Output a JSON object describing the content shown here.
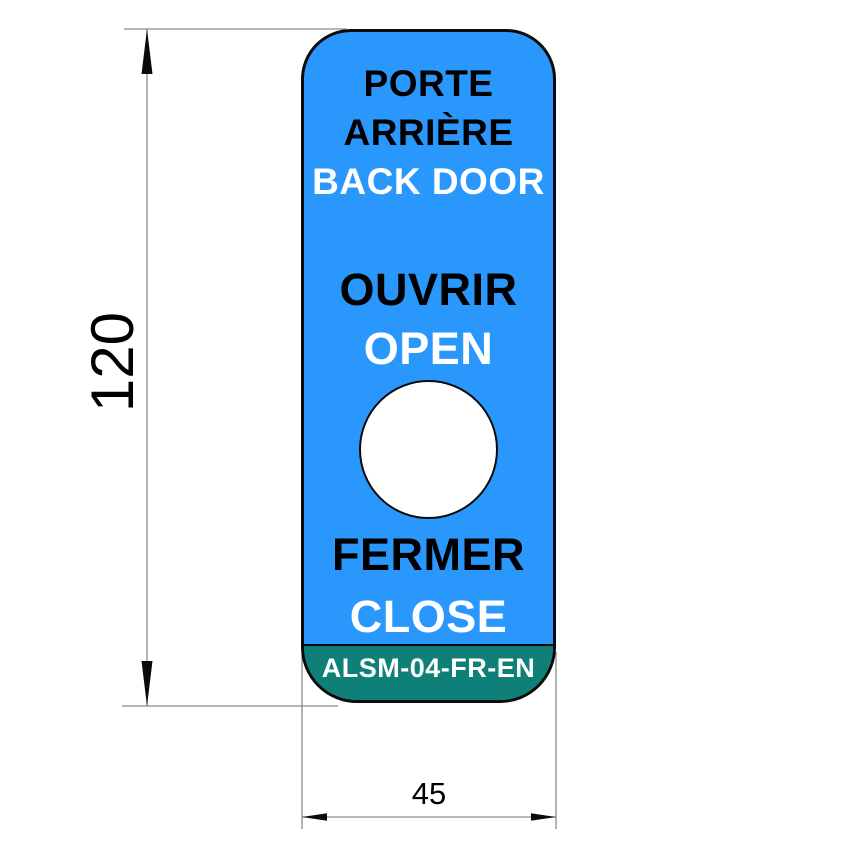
{
  "colors": {
    "tag_blue": "#2A97FC",
    "band_teal": "#0F8078",
    "outline_black": "#0B0B0B",
    "dim_gray": "#8A8A8A",
    "text_black": "#000000",
    "text_white": "#FFFFFF"
  },
  "tag": {
    "door_fr_line1": "PORTE",
    "door_fr_line2": "ARRIÈRE",
    "door_en": "BACK DOOR",
    "open_fr": "OUVRIR",
    "open_en": "OPEN",
    "close_fr": "FERMER",
    "close_en": "CLOSE",
    "part_number": "ALSM-04-FR-EN"
  },
  "dimensions": {
    "height_value": "120",
    "width_value": "45"
  }
}
